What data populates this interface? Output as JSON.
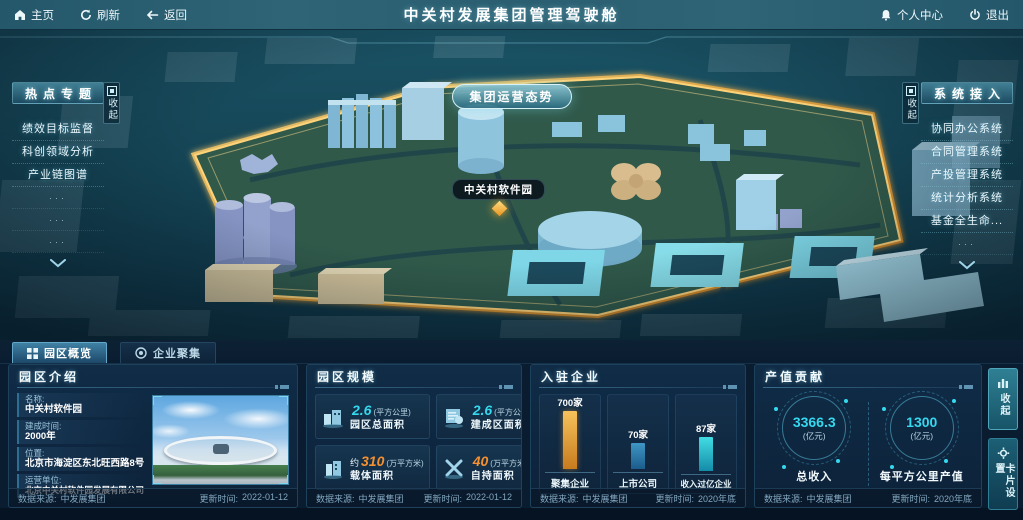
{
  "topbar": {
    "home": "主页",
    "refresh": "刷新",
    "back": "返回",
    "title": "中关村发展集团管理驾驶舱",
    "profile": "个人中心",
    "logout": "退出"
  },
  "map": {
    "situation_button": "集团运营态势",
    "marker_label": "中关村软件园"
  },
  "hot_topics": {
    "title": "热点专题",
    "collapse": "收起",
    "items": [
      "绩效目标监督",
      "科创领域分析",
      "产业链图谱"
    ],
    "ellipsis": "···"
  },
  "systems": {
    "title": "系统接入",
    "collapse": "收起",
    "items": [
      "协同办公系统",
      "合同管理系统",
      "产投管理系统",
      "统计分析系统",
      "基金全生命..."
    ],
    "ellipsis": "···"
  },
  "tabs": {
    "overview": "园区概览",
    "cluster": "企业聚集"
  },
  "intro_panel": {
    "title": "园区介绍",
    "fields": [
      {
        "label": "名称:",
        "value": "中关村软件园"
      },
      {
        "label": "建成时间:",
        "value": "2000年"
      },
      {
        "label": "位置:",
        "value": "北京市海淀区东北旺西路8号"
      },
      {
        "label": "运营单位:",
        "value": "北京中关村软件园发展有限公司"
      }
    ],
    "source_label": "数据来源:",
    "source": "中发展集团",
    "update_label": "更新时间:",
    "update_time": "2022-01-12"
  },
  "scale_panel": {
    "title": "园区规模",
    "stats": [
      {
        "prefix": "",
        "value": "2.6",
        "unit": "(平方公里)",
        "label": "园区总面积"
      },
      {
        "prefix": "",
        "value": "2.6",
        "unit": "(平方公里)",
        "label": "建成区面积"
      },
      {
        "prefix": "约",
        "value": "310",
        "unit": "(万平方米)",
        "label": "载体面积"
      },
      {
        "prefix": "",
        "value": "40",
        "unit": "(万平方米)",
        "label": "自持面积"
      }
    ],
    "source_label": "数据来源:",
    "source": "中发展集团",
    "update_label": "更新时间:",
    "update_time": "2022-01-12"
  },
  "enterprise_panel": {
    "title": "入驻企业",
    "source_label": "数据来源:",
    "source": "中发展集团",
    "update_label": "更新时间:",
    "update_time": "2020年底"
  },
  "chart_data": {
    "type": "bar",
    "title": "入驻企业",
    "categories": [
      "聚集企业",
      "上市公司",
      "收入过亿企业"
    ],
    "values": [
      700,
      70,
      87
    ],
    "value_labels": [
      "700家",
      "70家",
      "87家"
    ],
    "bar_colors": [
      "#e8a83c",
      "#2f86b4",
      "#35c8d8"
    ],
    "bar_heights_px": [
      "66px",
      "26px",
      "34px"
    ],
    "unit": "家",
    "grid": false,
    "legend": "none"
  },
  "output_panel": {
    "title": "产值贡献",
    "stats": [
      {
        "value": "3366.3",
        "unit": "(亿元)",
        "label": "总收入"
      },
      {
        "value": "1300",
        "unit": "(亿元)",
        "label": "每平方公里产值"
      }
    ],
    "source_label": "数据来源:",
    "source": "中发展集团",
    "update_label": "更新时间:",
    "update_time": "2020年底"
  },
  "right_rail": {
    "collapse": "收起",
    "card_settings": "卡片设置"
  },
  "colors": {
    "accent_cyan": "#35d8ee",
    "accent_orange": "#f59030",
    "park_glow": "#f0a830",
    "topbar_teal": "#2a5e70",
    "panel_bg": "#0c2239"
  }
}
